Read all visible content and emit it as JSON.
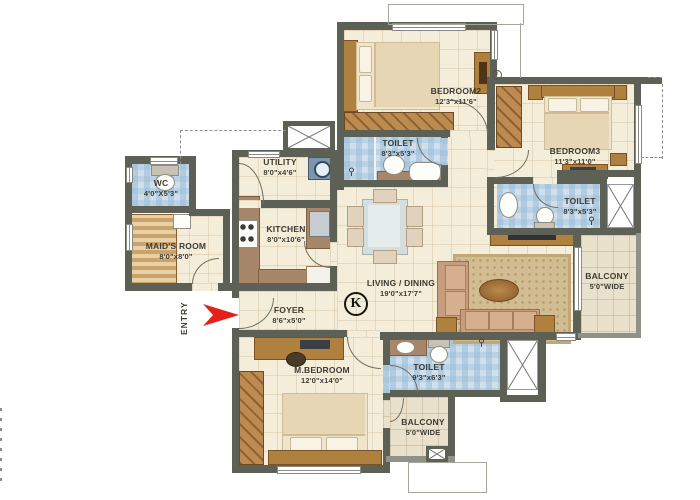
{
  "plan_type": "apartment-floor-plan",
  "rooms": {
    "bedroom2": {
      "name": "BEDROOM2",
      "dims": "12'3\"x11'6\""
    },
    "toilet2": {
      "name": "TOILET",
      "dims": "8'3\"x5'3\""
    },
    "bedroom3": {
      "name": "BEDROOM3",
      "dims": "11'3\"x11'0\""
    },
    "toilet3": {
      "name": "TOILET",
      "dims": "8'3\"x5'3\""
    },
    "wc": {
      "name": "WC",
      "dims": "4'0\"X5'3\""
    },
    "maids_room": {
      "name": "MAID'S ROOM",
      "dims": "8'0\"x8'0\""
    },
    "utility": {
      "name": "UTILITY",
      "dims": "8'0\"x4'6\""
    },
    "kitchen": {
      "name": "KITCHEN",
      "dims": "8'0\"x10'6\""
    },
    "living_dining": {
      "name": "LIVING / DINING",
      "dims": "19'0\"x17'7\""
    },
    "foyer": {
      "name": "FOYER",
      "dims": "8'6\"x5'0\""
    },
    "master_bedroom": {
      "name": "M.BEDROOM",
      "dims": "12'0\"x14'0\""
    },
    "master_toilet": {
      "name": "TOILET",
      "dims": "9'3\"x6'3\""
    },
    "balcony_bottom": {
      "name": "BALCONY",
      "dims": "5'0\"WIDE"
    },
    "balcony_right": {
      "name": "BALCONY",
      "dims": "5'0\"WIDE"
    }
  },
  "symbols": {
    "entry_label": "ENTRY",
    "kitchen_marker": "K",
    "vent_marker": "x"
  },
  "colors": {
    "wall": "#5c6055",
    "floor_tile": "#f4edda",
    "bathroom_tile": "#cfdfec",
    "balcony_tile": "#e9e1cc",
    "wood": "#b0803f",
    "entry_arrow_red": "#e32119"
  }
}
